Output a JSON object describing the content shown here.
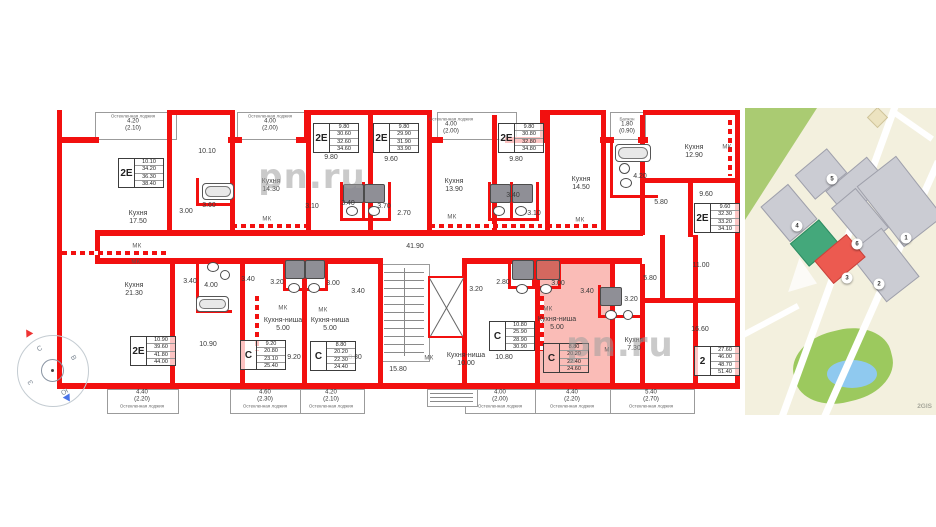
{
  "watermarks": [
    {
      "t": "pn.ru",
      "x": 312,
      "y": 177,
      "s": 34
    },
    {
      "t": "pn.ru",
      "x": 620,
      "y": 345,
      "s": 34
    },
    {
      "t": "pn.ru",
      "x": 800,
      "y": 207,
      "s": 34
    }
  ],
  "floorplan": {
    "highlights": [
      [
        540,
        258,
        70,
        126
      ],
      [
        535,
        389,
        75,
        23
      ]
    ],
    "walls": [
      [
        57,
        110,
        5,
        279
      ],
      [
        735,
        110,
        5,
        279
      ],
      [
        57,
        137,
        42,
        6
      ],
      [
        167,
        110,
        68,
        5
      ],
      [
        167,
        110,
        5,
        33
      ],
      [
        230,
        110,
        5,
        33
      ],
      [
        228,
        137,
        14,
        6
      ],
      [
        296,
        137,
        14,
        6
      ],
      [
        304,
        110,
        128,
        5
      ],
      [
        304,
        110,
        5,
        33
      ],
      [
        427,
        110,
        5,
        33
      ],
      [
        427,
        137,
        16,
        6
      ],
      [
        505,
        137,
        40,
        6
      ],
      [
        540,
        110,
        66,
        5
      ],
      [
        540,
        110,
        5,
        33
      ],
      [
        601,
        110,
        5,
        33
      ],
      [
        600,
        137,
        14,
        6
      ],
      [
        638,
        137,
        10,
        6
      ],
      [
        643,
        110,
        97,
        5
      ],
      [
        57,
        383,
        683,
        6
      ],
      [
        167,
        140,
        5,
        95
      ],
      [
        230,
        140,
        5,
        95
      ],
      [
        306,
        115,
        5,
        120
      ],
      [
        368,
        115,
        5,
        120
      ],
      [
        427,
        140,
        5,
        95
      ],
      [
        492,
        115,
        5,
        120
      ],
      [
        545,
        115,
        5,
        120
      ],
      [
        601,
        115,
        5,
        120
      ],
      [
        640,
        115,
        5,
        120
      ],
      [
        688,
        180,
        5,
        57
      ],
      [
        643,
        178,
        97,
        5
      ],
      [
        643,
        298,
        97,
        5
      ],
      [
        660,
        235,
        5,
        63
      ],
      [
        95,
        230,
        548,
        6
      ],
      [
        95,
        258,
        288,
        6
      ],
      [
        462,
        258,
        180,
        6
      ],
      [
        95,
        230,
        5,
        34
      ],
      [
        170,
        258,
        5,
        131
      ],
      [
        240,
        258,
        5,
        131
      ],
      [
        302,
        258,
        5,
        131
      ],
      [
        378,
        258,
        5,
        131
      ],
      [
        462,
        258,
        5,
        131
      ],
      [
        535,
        258,
        5,
        131
      ],
      [
        610,
        258,
        5,
        131
      ],
      [
        640,
        264,
        5,
        125
      ],
      [
        693,
        235,
        5,
        154
      ],
      [
        340,
        182,
        3,
        39
      ],
      [
        362,
        182,
        3,
        39
      ],
      [
        388,
        182,
        3,
        39
      ],
      [
        340,
        218,
        51,
        3
      ],
      [
        488,
        182,
        3,
        39
      ],
      [
        510,
        182,
        3,
        39
      ],
      [
        536,
        182,
        3,
        39
      ],
      [
        488,
        218,
        51,
        3
      ],
      [
        610,
        140,
        3,
        58
      ],
      [
        610,
        195,
        48,
        3
      ],
      [
        283,
        258,
        3,
        33
      ],
      [
        303,
        258,
        3,
        33
      ],
      [
        325,
        258,
        3,
        33
      ],
      [
        283,
        288,
        45,
        3
      ],
      [
        508,
        258,
        3,
        31
      ],
      [
        532,
        258,
        3,
        31
      ],
      [
        558,
        258,
        3,
        31
      ],
      [
        508,
        286,
        53,
        3
      ],
      [
        598,
        285,
        3,
        33
      ],
      [
        598,
        315,
        42,
        3
      ],
      [
        196,
        258,
        3,
        55
      ],
      [
        196,
        310,
        36,
        3
      ],
      [
        196,
        178,
        3,
        28
      ],
      [
        196,
        203,
        38,
        3
      ]
    ],
    "dashed_walls": [
      [
        62,
        251,
        105,
        4
      ],
      [
        232,
        224,
        74,
        4
      ],
      [
        430,
        224,
        112,
        4
      ],
      [
        547,
        224,
        55,
        4
      ],
      [
        728,
        120,
        4,
        56
      ],
      [
        255,
        296,
        4,
        55
      ],
      [
        540,
        296,
        4,
        55
      ]
    ],
    "thin_boxes": [
      [
        95,
        112,
        80,
        26
      ],
      [
        237,
        112,
        68,
        26
      ],
      [
        437,
        112,
        78,
        26
      ],
      [
        610,
        112,
        34,
        26
      ],
      [
        107,
        389,
        70,
        23
      ],
      [
        230,
        389,
        70,
        23
      ],
      [
        300,
        389,
        63,
        23
      ],
      [
        465,
        389,
        70,
        23
      ],
      [
        535,
        389,
        75,
        23
      ],
      [
        610,
        389,
        83,
        23
      ],
      [
        427,
        389,
        49,
        16
      ],
      [
        380,
        264,
        48,
        96
      ]
    ],
    "extra_lines": [
      [
        430,
        393,
        43,
        1
      ],
      [
        430,
        397,
        43,
        1
      ],
      [
        430,
        401,
        43,
        1
      ]
    ],
    "stairs": {
      "x": 384,
      "y0": 272,
      "w": 40,
      "step": 8,
      "n": 11,
      "divx": 404,
      "divy": 268,
      "divh": 88
    },
    "elevator": {
      "box": [
        428,
        276,
        37,
        62
      ]
    },
    "fixtures": [
      {
        "k": "tub",
        "r": [
          202,
          183,
          30,
          15
        ]
      },
      {
        "k": "tub",
        "r": [
          615,
          144,
          34,
          16
        ]
      },
      {
        "k": "tub",
        "r": [
          196,
          296,
          31,
          14
        ]
      },
      {
        "k": "tray",
        "r": [
          343,
          184,
          19,
          17
        ]
      },
      {
        "k": "tray",
        "r": [
          364,
          184,
          19,
          17
        ]
      },
      {
        "k": "tray",
        "r": [
          490,
          184,
          19,
          17
        ]
      },
      {
        "k": "tray",
        "r": [
          512,
          184,
          19,
          17
        ]
      },
      {
        "k": "tray",
        "r": [
          285,
          260,
          18,
          17
        ]
      },
      {
        "k": "tray",
        "r": [
          305,
          260,
          18,
          17
        ]
      },
      {
        "k": "tray",
        "r": [
          600,
          287,
          20,
          17
        ]
      },
      {
        "k": "tray",
        "r": [
          512,
          260,
          20,
          18
        ]
      },
      {
        "k": "trayr",
        "r": [
          536,
          260,
          22,
          18
        ]
      },
      {
        "k": "wc",
        "r": [
          346,
          206,
          10,
          8
        ]
      },
      {
        "k": "wc",
        "r": [
          368,
          206,
          10,
          8
        ]
      },
      {
        "k": "wc",
        "r": [
          493,
          206,
          10,
          8
        ]
      },
      {
        "k": "wc",
        "r": [
          515,
          206,
          10,
          8
        ]
      },
      {
        "k": "wc",
        "r": [
          288,
          283,
          10,
          8
        ]
      },
      {
        "k": "wc",
        "r": [
          308,
          283,
          10,
          8
        ]
      },
      {
        "k": "wc",
        "r": [
          516,
          284,
          10,
          8
        ]
      },
      {
        "k": "wc",
        "r": [
          540,
          284,
          10,
          8
        ]
      },
      {
        "k": "wc",
        "r": [
          605,
          310,
          10,
          8
        ]
      },
      {
        "k": "wc",
        "r": [
          207,
          262,
          10,
          8
        ]
      },
      {
        "k": "wc",
        "r": [
          620,
          178,
          10,
          8
        ]
      },
      {
        "k": "sink",
        "r": [
          220,
          270,
          8,
          8
        ]
      },
      {
        "k": "sink",
        "r": [
          619,
          163,
          9,
          9
        ]
      },
      {
        "k": "sink",
        "r": [
          623,
          310,
          8,
          8
        ]
      }
    ],
    "labels": [
      {
        "t": "10.10",
        "x": 207,
        "y": 152
      },
      {
        "t": "Кухня\n17.50",
        "x": 138,
        "y": 218
      },
      {
        "t": "3.00",
        "x": 186,
        "y": 212
      },
      {
        "t": "3.60",
        "x": 209,
        "y": 206
      },
      {
        "t": "Кухня\n14.30",
        "x": 271,
        "y": 186
      },
      {
        "t": "МК",
        "x": 137,
        "y": 247
      },
      {
        "t": "МК",
        "x": 267,
        "y": 220
      },
      {
        "t": "9.80",
        "x": 331,
        "y": 158
      },
      {
        "t": "9.60",
        "x": 391,
        "y": 160
      },
      {
        "t": "3.10",
        "x": 312,
        "y": 207
      },
      {
        "t": "3.40",
        "x": 348,
        "y": 204
      },
      {
        "t": "3.70",
        "x": 384,
        "y": 207
      },
      {
        "t": "2.70",
        "x": 404,
        "y": 214
      },
      {
        "t": "Кухня\n13.90",
        "x": 454,
        "y": 186
      },
      {
        "t": "МК",
        "x": 452,
        "y": 218
      },
      {
        "t": "41.90",
        "x": 415,
        "y": 247
      },
      {
        "t": "9.80",
        "x": 516,
        "y": 160
      },
      {
        "t": "3.40",
        "x": 513,
        "y": 196
      },
      {
        "t": "3.10",
        "x": 534,
        "y": 214
      },
      {
        "t": "Кухня\n14.50",
        "x": 581,
        "y": 184
      },
      {
        "t": "МК",
        "x": 580,
        "y": 221
      },
      {
        "t": "4.20",
        "x": 640,
        "y": 177
      },
      {
        "t": "Кухня\n12.90",
        "x": 694,
        "y": 152
      },
      {
        "t": "МК",
        "x": 727,
        "y": 148
      },
      {
        "t": "5.80",
        "x": 661,
        "y": 203
      },
      {
        "t": "9.60",
        "x": 706,
        "y": 195
      },
      {
        "t": "11.00",
        "x": 701,
        "y": 266
      },
      {
        "t": "5.80",
        "x": 650,
        "y": 279
      },
      {
        "t": "3.20",
        "x": 631,
        "y": 300
      },
      {
        "t": "16.60",
        "x": 700,
        "y": 330
      },
      {
        "t": "МК",
        "x": 609,
        "y": 351
      },
      {
        "t": "Кухня\n7.30",
        "x": 634,
        "y": 345
      },
      {
        "t": "Кухня\n21.30",
        "x": 134,
        "y": 290
      },
      {
        "t": "МК",
        "x": 136,
        "y": 263
      },
      {
        "t": "3.40",
        "x": 190,
        "y": 282
      },
      {
        "t": "4.00",
        "x": 211,
        "y": 286
      },
      {
        "t": "10.90",
        "x": 208,
        "y": 345
      },
      {
        "t": "3.40",
        "x": 248,
        "y": 280
      },
      {
        "t": "3.20",
        "x": 277,
        "y": 283
      },
      {
        "t": "МК",
        "x": 283,
        "y": 309
      },
      {
        "t": "Кухня-ниша\n5.00",
        "x": 283,
        "y": 325
      },
      {
        "t": "9.20",
        "x": 294,
        "y": 358
      },
      {
        "t": "3.00",
        "x": 333,
        "y": 284
      },
      {
        "t": "3.40",
        "x": 358,
        "y": 292
      },
      {
        "t": "МК",
        "x": 323,
        "y": 311
      },
      {
        "t": "Кухня-ниша\n5.00",
        "x": 330,
        "y": 325
      },
      {
        "t": "8.80",
        "x": 355,
        "y": 358
      },
      {
        "t": "15.80",
        "x": 398,
        "y": 370
      },
      {
        "t": "МК",
        "x": 429,
        "y": 359
      },
      {
        "t": "Кухня-ниша\n10.00",
        "x": 466,
        "y": 360
      },
      {
        "t": "10.80",
        "x": 504,
        "y": 358
      },
      {
        "t": "3.20",
        "x": 476,
        "y": 290
      },
      {
        "t": "2.80",
        "x": 503,
        "y": 283
      },
      {
        "t": "МК",
        "x": 548,
        "y": 310
      },
      {
        "t": "Кухня-ниша\n5.00",
        "x": 557,
        "y": 324
      },
      {
        "t": "3.00",
        "x": 558,
        "y": 284
      },
      {
        "t": "3.40",
        "x": 587,
        "y": 292
      }
    ],
    "loggia_labels": [
      {
        "x": 133,
        "y": 123,
        "v": "4.20",
        "s": "(2.10)",
        "c": "Остекленная лоджия",
        "pos": "top"
      },
      {
        "x": 270,
        "y": 123,
        "v": "4.00",
        "s": "(2.00)",
        "c": "Остекленная лоджия",
        "pos": "top"
      },
      {
        "x": 451,
        "y": 126,
        "v": "4.00",
        "s": "(2.00)",
        "c": "Остекленная лоджия",
        "pos": "top"
      },
      {
        "x": 627,
        "y": 126,
        "v": "1.80",
        "s": "(0.90)",
        "c": "Балкон",
        "pos": "top"
      },
      {
        "x": 142,
        "y": 399,
        "v": "4.40",
        "s": "(2.20)",
        "c": "Остекленная лоджия",
        "pos": "bottom"
      },
      {
        "x": 265,
        "y": 399,
        "v": "4.60",
        "s": "(2.30)",
        "c": "Остекленная лоджия",
        "pos": "bottom"
      },
      {
        "x": 331,
        "y": 399,
        "v": "4.20",
        "s": "(2.10)",
        "c": "Остекленная лоджия",
        "pos": "bottom"
      },
      {
        "x": 500,
        "y": 399,
        "v": "4.00",
        "s": "(2.00)",
        "c": "Остекленная лоджия",
        "pos": "bottom"
      },
      {
        "x": 572,
        "y": 399,
        "v": "4.40",
        "s": "(2.20)",
        "c": "Остекленная лоджия",
        "pos": "bottom"
      },
      {
        "x": 651,
        "y": 399,
        "v": "5.40",
        "s": "(2.70)",
        "c": "Остекленная лоджия",
        "pos": "bottom"
      }
    ],
    "unit_tables": [
      {
        "x": 118,
        "y": 158,
        "type": "2Е",
        "vals": [
          "10.10",
          "34.20",
          "36.30",
          "38.40"
        ]
      },
      {
        "x": 313,
        "y": 123,
        "type": "2Е",
        "vals": [
          "9.80",
          "30.60",
          "32.60",
          "34.60"
        ]
      },
      {
        "x": 373,
        "y": 123,
        "type": "2Е",
        "vals": [
          "9.80",
          "29.90",
          "31.90",
          "33.90"
        ]
      },
      {
        "x": 498,
        "y": 123,
        "type": "2Е",
        "vals": [
          "9.80",
          "30.80",
          "32.80",
          "34.80"
        ]
      },
      {
        "x": 694,
        "y": 203,
        "type": "2Е",
        "vals": [
          "9.60",
          "32.30",
          "33.20",
          "34.10"
        ]
      },
      {
        "x": 130,
        "y": 336,
        "type": "2Е",
        "vals": [
          "10.90",
          "39.60",
          "41.80",
          "44.00"
        ]
      },
      {
        "x": 240,
        "y": 340,
        "type": "С",
        "vals": [
          "9.20",
          "20.80",
          "23.10",
          "25.40"
        ]
      },
      {
        "x": 310,
        "y": 341,
        "type": "С",
        "vals": [
          "8.80",
          "20.20",
          "22.30",
          "24.40"
        ]
      },
      {
        "x": 489,
        "y": 321,
        "type": "С",
        "vals": [
          "10.80",
          "25.90",
          "28.90",
          "30.90"
        ]
      },
      {
        "x": 543,
        "y": 343,
        "type": "С",
        "vals": [
          "8.80",
          "20.20",
          "22.40",
          "24.60"
        ],
        "hl": true
      },
      {
        "x": 694,
        "y": 346,
        "type": "2",
        "vals": [
          "27.60",
          "46.00",
          "48.70",
          "51.40"
        ]
      }
    ]
  },
  "compass": {
    "cx": 52,
    "cy": 370,
    "letter_r": 24,
    "letters": [
      {
        "t": "С",
        "a": -120
      },
      {
        "t": "В",
        "a": -30
      },
      {
        "t": "Ю",
        "a": 60
      },
      {
        "t": "З",
        "a": 150
      }
    ]
  },
  "map": {
    "logo": "2GIS",
    "roads": [
      [
        148,
        -6,
        7,
        335,
        20
      ],
      [
        190,
        52,
        7,
        295,
        24
      ],
      [
        -10,
        228,
        70,
        6,
        -28
      ],
      [
        148,
        0,
        50,
        6,
        35
      ]
    ],
    "buildings": [
      {
        "r": [
          55,
          50,
          40,
          30
        ],
        "rot": -40
      },
      {
        "r": [
          85,
          62,
          52,
          32
        ],
        "rot": -40
      },
      {
        "r": [
          130,
          55,
          48,
          75
        ],
        "rot": -38
      },
      {
        "r": [
          26,
          82,
          34,
          44
        ],
        "rot": -40
      },
      {
        "r": [
          99,
          84,
          30,
          50
        ],
        "rot": -40
      },
      {
        "r": [
          118,
          126,
          40,
          60
        ],
        "rot": -38
      },
      {
        "r": [
          50,
          120,
          36,
          28
        ],
        "rot": -40,
        "c": "green"
      },
      {
        "r": [
          74,
          136,
          40,
          28
        ],
        "rot": -40,
        "c": "red"
      },
      {
        "r": [
          125,
          2,
          13,
          13
        ],
        "rot": 45,
        "c": "beige"
      }
    ],
    "markers": [
      {
        "n": "5",
        "x": 87,
        "y": 71
      },
      {
        "n": "4",
        "x": 52,
        "y": 118
      },
      {
        "n": "6",
        "x": 112,
        "y": 136
      },
      {
        "n": "1",
        "x": 161,
        "y": 130
      },
      {
        "n": "3",
        "x": 102,
        "y": 170
      },
      {
        "n": "2",
        "x": 134,
        "y": 176
      }
    ]
  }
}
